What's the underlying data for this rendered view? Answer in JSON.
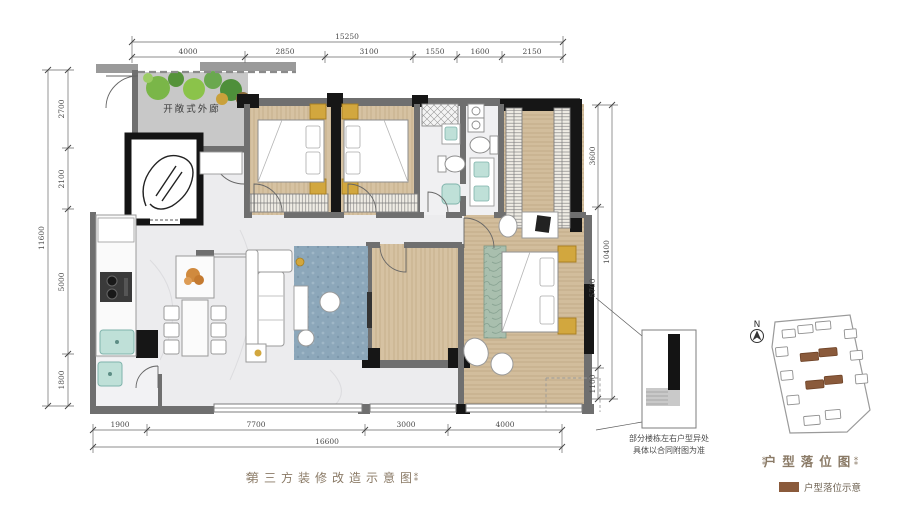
{
  "dims": {
    "top": {
      "total": "15250",
      "segments": [
        "4000",
        "2850",
        "3100",
        "1550",
        "1600",
        "2150"
      ]
    },
    "bottom": {
      "total": "16600",
      "segments": [
        "1900",
        "7700",
        "3000",
        "4000"
      ]
    },
    "left": {
      "total": "11600",
      "segments": [
        "2700",
        "2100",
        "5000",
        "1800"
      ]
    },
    "right": {
      "total": "10400",
      "segments": [
        "3600",
        "5700",
        "1100"
      ]
    }
  },
  "plan": {
    "corridor_label": "开敞式外廊"
  },
  "callout": {
    "note_line1": "部分楼栋左右户型异处",
    "note_line2": "具体以合同附图为准"
  },
  "footer": {
    "ornament_left": "⁑",
    "title": "第三方装修改造示意图",
    "ornament_right": "⁑"
  },
  "locator": {
    "compass_label": "N",
    "ornament_left": "⁑",
    "title": "户型落位图",
    "ornament_right": "⁑",
    "legend_label": "户型落位示意"
  },
  "colors": {
    "wall_gray": "#6f6f6f",
    "wall_black": "#161616",
    "wood_floor": "#d6c2a2",
    "tile_floor": "#ececee",
    "corridor_floor": "#c8c8c8",
    "rug_blue": "#8ca7ba",
    "fixture_teal": "#bfe0d8",
    "accent_gold": "#d2a73e",
    "plant_green": "#6aa84f",
    "building_brown": "#8a5a3b",
    "title_brown": "#8a7a66"
  }
}
